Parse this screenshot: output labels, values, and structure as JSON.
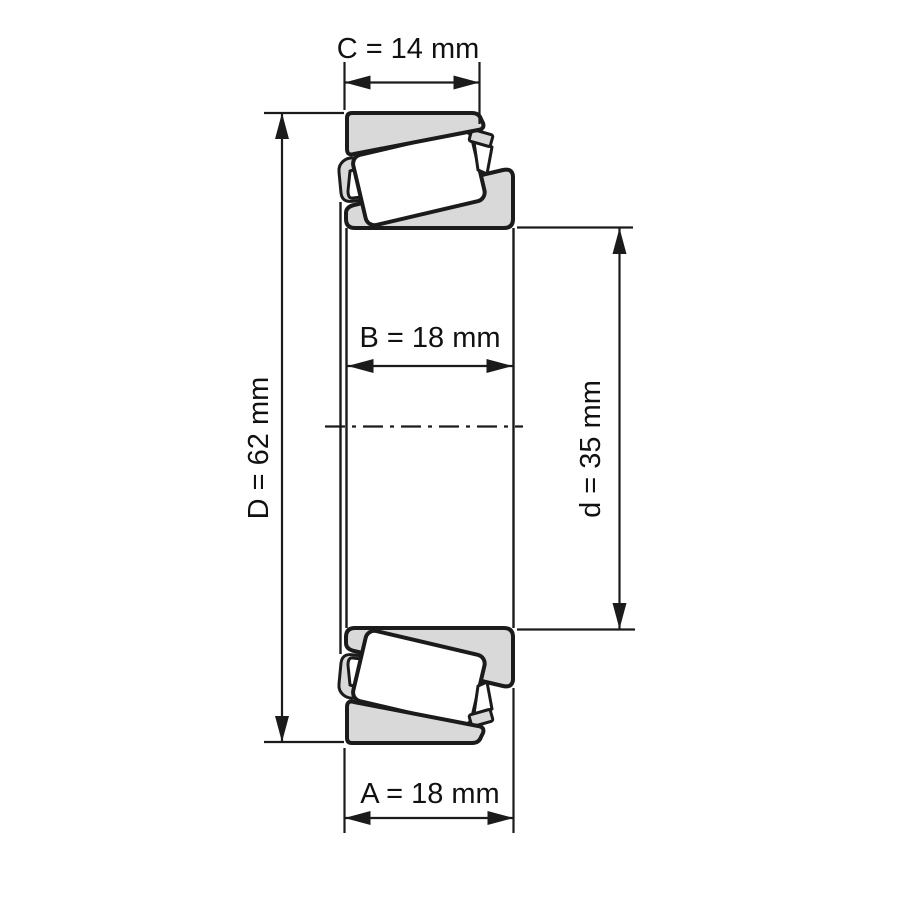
{
  "diagram": {
    "dimensions": {
      "C": {
        "name": "C",
        "value": 14,
        "unit": "mm",
        "label": "C = 14 mm"
      },
      "D": {
        "name": "D",
        "value": 62,
        "unit": "mm",
        "label": "D = 62 mm"
      },
      "B": {
        "name": "B",
        "value": 18,
        "unit": "mm",
        "label": "B = 18 mm"
      },
      "d": {
        "name": "d",
        "value": 35,
        "unit": "mm",
        "label": "d = 35 mm"
      },
      "A": {
        "name": "A",
        "value": 18,
        "unit": "mm",
        "label": "A = 18 mm"
      }
    },
    "colors": {
      "ring_fill": "#d9d9d9",
      "roller_fill": "#ffffff",
      "line": "#1b1b1b",
      "background": "#ffffff"
    }
  }
}
